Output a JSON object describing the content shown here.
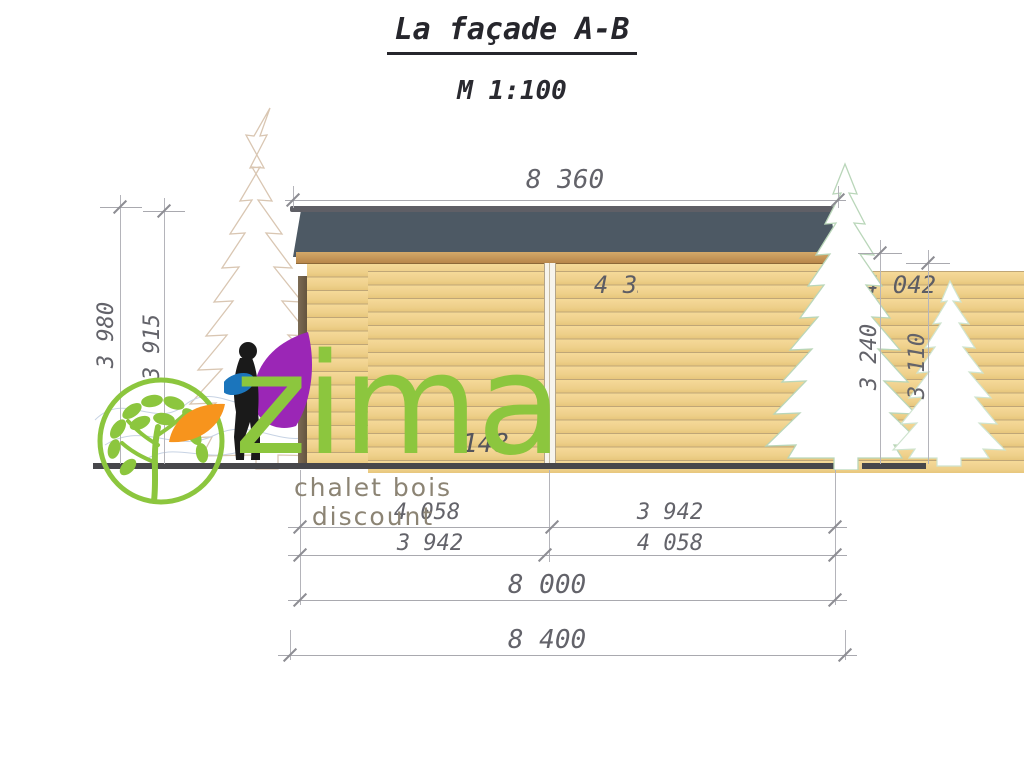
{
  "title": "La façade A-B",
  "scale_label": "M 1:100",
  "dimensions": {
    "top_width": "8 360",
    "wall_left_segment": "4 358",
    "wall_right_segment": "4 042",
    "height_left_outer": "3 980",
    "height_left_inner": "3 915",
    "height_right_outer": "3 240",
    "height_right_inner": "3 110",
    "base_offset": "148",
    "row1_left": "4 058",
    "row1_right": "3 942",
    "row2_left": "3 942",
    "row2_right": "4 058",
    "total_wall": "8 000",
    "total_overall": "8 400"
  },
  "watermark": {
    "brand": "zima",
    "tagline": "chalet bois discount",
    "colors": {
      "green": "#8cc63e",
      "orange": "#f7941d",
      "purple": "#9b26b6",
      "blue": "#1b75bc",
      "silhouette": "#1a1a1a",
      "taupe": "#8c8474"
    }
  },
  "drawing_colors": {
    "wood": "#f2d492",
    "roof_shingles": "#4d5964",
    "fascia": "#c2945a",
    "ground": "#47474b",
    "dimension_text": "#63636a"
  }
}
